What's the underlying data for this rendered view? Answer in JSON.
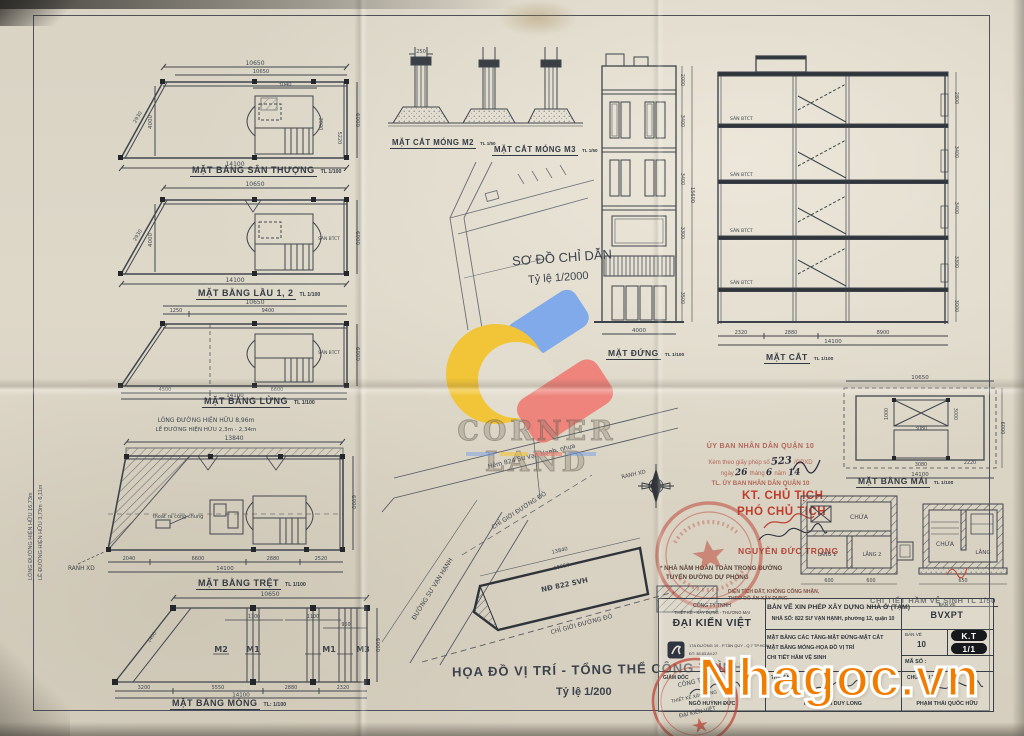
{
  "watermarks": {
    "corner_land": "CORNER LAND",
    "nhagoc": "Nhagoc.vn"
  },
  "plans": {
    "san_thuong": {
      "title": "MẶT BẰNG SÂN THƯỢNG",
      "scale": "TL 1/100",
      "dim_top": "10650",
      "dim_top2": "10650",
      "dim_core_w": "3040",
      "dim_core_h": "3000",
      "dim_small": "5220",
      "dim_bottom": "14100",
      "dim_left": "4000",
      "dim_right": "6000",
      "dim_slant": "2930"
    },
    "lau12": {
      "title": "MẶT BẰNG LẦU 1, 2",
      "scale": "TL 1/100",
      "dim_top": "10650",
      "dim_bottom": "14100",
      "dim_left": "4000",
      "dim_right": "6000",
      "dim_slant": "2930",
      "room": "SÀN BTCT"
    },
    "lung": {
      "title": "MẶT BẰNG LỬNG",
      "scale": "TL 1/100",
      "dim_top": "10650",
      "dim_top_a": "1250",
      "dim_top_b": "9400",
      "dim_bot_a": "4500",
      "dim_bot_b": "6600",
      "dim_bottom": "14100",
      "dim_right": "6000",
      "room": "SÀN BTCT"
    },
    "tret": {
      "title": "MẶT BẰNG TRỆT",
      "scale": "TL 1/100",
      "above1": "LÒNG ĐƯỜNG HIỆN HỮU 8,96m",
      "above2": "LỀ ĐƯỜNG HIỆN HỮU 2,3m - 2,34m",
      "left1": "LÒNG ĐƯỜNG HIỆN HỮU 16,73m",
      "left2": "LỀ ĐƯỜNG HIỆN HỮU 3,73m - 6,11m",
      "ranh": "RANH XD",
      "note": "thoát ra cống chung",
      "dim_top": "13840",
      "dim_bot_a": "2040",
      "dim_bot_b": "6600",
      "dim_bot_c": "2880",
      "dim_bot_d": "2520",
      "dim_bottom": "14100",
      "dim_right": "6000"
    },
    "mong": {
      "title": "MẶT BẰNG MÓNG",
      "scale": "TL: 1/100",
      "m2": "M2",
      "m1a": "M1",
      "m1b": "M1",
      "m3": "M3",
      "dim_top": "10650",
      "span_a": "1100",
      "span_b": "1100",
      "span_c": "950",
      "dim_diag": "1400",
      "dim_bot_a": "3200",
      "dim_bot_b": "5550",
      "dim_bot_c": "2880",
      "dim_bot_d": "2320",
      "dim_bottom": "14100",
      "dim_right": "6000"
    }
  },
  "footings": {
    "m2_title": "MẶT CẮT MÓNG M2",
    "m2_scale": "TL 1/50",
    "m3_title": "MẶT CẮT MÓNG M3",
    "m3_scale": "TL 1/50",
    "dim": "250"
  },
  "key_map": {
    "title": "SƠ ĐỒ CHỈ DẪN",
    "scale": "Tỷ lệ 1/2000"
  },
  "elevation": {
    "title": "MẶT ĐỨNG",
    "scale": "TL 1/100",
    "dim_bottom": "4000",
    "dims_right": [
      "2000",
      "3400",
      "3400",
      "3300",
      "3500"
    ],
    "dim_total": "15600"
  },
  "section": {
    "title": "MẶT CẮT",
    "scale": "TL 1/100",
    "slab": "SÀN BTCT",
    "dim_a": "2320",
    "dim_b": "2880",
    "dim_c": "8900",
    "dim_total": "14100",
    "dims_right": [
      "2800",
      "3400",
      "3400",
      "3300",
      "3000"
    ]
  },
  "roof": {
    "title": "MẶT BẰNG MÁI",
    "scale": "TL 1/100",
    "dim_top": "10650",
    "dim_bottom": "14100",
    "dim_a": "3080",
    "dim_b": "3080",
    "dim_c": "3000",
    "dim_d": "2220",
    "dim_e": "1000",
    "dim_right": "6000"
  },
  "site": {
    "caption": "HỌA ĐỒ VỊ TRÍ - TỔNG THỂ CÔNG TRÌNH",
    "scale": "Tỷ lệ 1/200",
    "street": "Hẻm 824 Sư Vạn Hạnh, nhựa",
    "main_road": "ĐƯỜNG SƯ VẠN HẠNH",
    "lot": "NĐ 822 SVH",
    "red_line": "CHỈ GIỚI ĐƯỜNG ĐỎ",
    "red_line2": "CHỈ GIỚI ĐƯỜNG ĐỎ",
    "ranh": "RANH XD",
    "dim_top": "13840",
    "dim_inner": "10650"
  },
  "stamp": {
    "line1": "ỦY BAN NHÂN DÂN QUẬN 10",
    "line2_pre": "Kèm theo giấy phép số",
    "hand_no": "523",
    "line2_post": "/GPXD",
    "line3_pre": "ngày",
    "hand_day": "26",
    "line3_mid": "tháng",
    "hand_month": "6",
    "line3_post": "năm",
    "hand_year": "14",
    "line4": "TL. ỦY BAN NHÂN DÂN QUẬN 10",
    "kt": "KT. CHỦ TỊCH",
    "pho": "PHÓ CHỦ TỊCH",
    "name": "NGUYỄN ĐỨC TRỌNG",
    "note1": "* NHÀ NẰM HOÀN TOÀN TRONG ĐƯỜNG",
    "note2": "TUYẾN ĐƯỜNG DỰ PHÒNG",
    "legend1": "DIỆN TÍCH ĐẤT, KHÔNG CÔNG NHẬN,",
    "legend2": "THEO ĐỒ ÁN XÂY DỰNG."
  },
  "septic": {
    "caption": "CHI TIẾT HẦM VỆ SINH TL 1/50",
    "chua": "CHỨA",
    "lang1": "LẮNG 1",
    "lang2": "LẮNG 2",
    "sec_chua": "CHỨA",
    "sec_lang": "LẮNG",
    "dim_a": "600",
    "dim_b": "600",
    "dim_c": "650"
  },
  "title_block": {
    "company_type": "CÔNG TY TNHH",
    "company_fields": "THIẾT KẾ - XÂY DỰNG - THƯƠNG MẠI",
    "company_name": "ĐẠI KIẾN VIỆT",
    "address": "17A ĐƯỜNG 19 - P.TÂN QUY - Q.7 TP.HCM",
    "phone": "ĐT: 38.83.84.27",
    "title": "BẢN VẼ  XIN PHÉP XÂY DỰNG NHÀ Ở (TẠM)",
    "subtitle": "NHÀ SỐ: 822 SƯ VẠN HẠNH, phường 12, quận 10",
    "content1": "MẶT BẰNG CÁC TẦNG-MẶT ĐỨNG-MẶT CẮT",
    "content2": "MẶT BẰNG MÓNG-HỌA ĐỒ VỊ TRÍ",
    "content3": "CHI TIẾT HẦM VỆ SINH",
    "ban_ve_label": "BẢN VẼ",
    "ban_ve_code": "BVXPT",
    "sheet_label": "BẢN VẼ",
    "sheet_no": "10",
    "ma_so": "MÃ SỐ :",
    "badge_kt": "K.T",
    "badge_ratio": "1/1",
    "role1": "GIÁM ĐỐC",
    "name1": "NGÔ HUỲNH ĐỨC",
    "role2": "THIẾT KẾ",
    "name2": "KTS.PHẠM DUY LONG",
    "role3": "CHỦ ĐẦU TƯ",
    "name3": "PHẠM THÁI QUỐC HỮU",
    "seal_line1": "CÔNG TY",
    "seal_line2": "THIẾT KẾ XÂY DỰNG",
    "seal_line3": "ĐẠI KIẾN VIỆT"
  }
}
